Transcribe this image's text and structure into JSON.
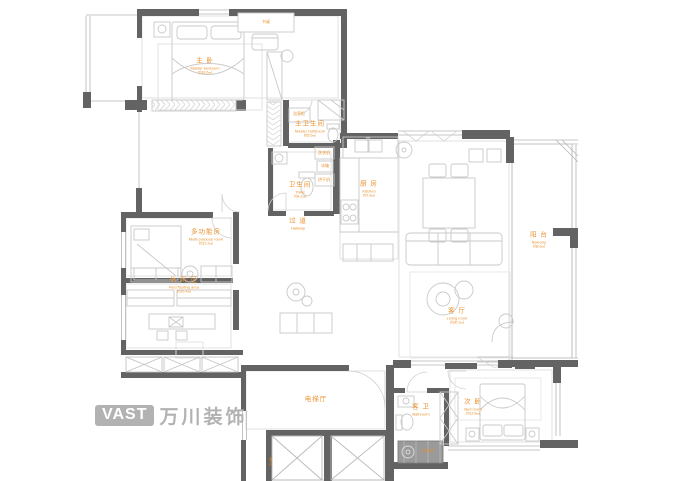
{
  "colors": {
    "wall": "#636363",
    "line": "#c9c9c9",
    "light_line": "#e0e0e0",
    "label_orange": "#e8922f",
    "logo_gray": "#b2b2b2",
    "dark_fixture": "#9a9a9a"
  },
  "logo": {
    "badge": "VAST",
    "name": "万川装饰"
  },
  "rooms": [
    {
      "id": "master-bedroom",
      "zh": "主 卧",
      "en": "Master bedroom",
      "area": "约18.6㎡"
    },
    {
      "id": "master-bathroom",
      "zh": "主卫生间",
      "en": "Master bathroom",
      "area": "约5.6㎡"
    },
    {
      "id": "bathroom",
      "zh": "卫生间",
      "en": "Toilet",
      "area": "约4.2㎡"
    },
    {
      "id": "hallway",
      "zh": "过 道",
      "en": "Hallway",
      "area": ""
    },
    {
      "id": "kitchen",
      "zh": "厨 房",
      "en": "Kitchen",
      "area": "约7.8㎡"
    },
    {
      "id": "living-room",
      "zh": "客 厅",
      "en": "Living room",
      "area": "约30.2㎡"
    },
    {
      "id": "balcony",
      "zh": "阳 台",
      "en": "Balcony",
      "area": "约8.6㎡"
    },
    {
      "id": "multi-purpose-room",
      "zh": "多功能房",
      "en": "Multi-purpose room",
      "area": "约13.2㎡"
    },
    {
      "id": "leisure-room",
      "zh": "休 闲 区",
      "en": "Rec/Tasting area",
      "area": "约16.4㎡"
    },
    {
      "id": "elevator-hall",
      "zh": "电梯厅",
      "en": "",
      "area": ""
    },
    {
      "id": "guest-bathroom",
      "zh": "客 卫",
      "en": "Bathroom",
      "area": ""
    },
    {
      "id": "second-bedroom",
      "zh": "次 卧",
      "en": "Bed room",
      "area": "约12.8㎡"
    }
  ],
  "fixtures": [
    {
      "id": "desk",
      "label": "书桌"
    },
    {
      "id": "vanity",
      "label": "浴室柜"
    },
    {
      "id": "washer",
      "label": "洗衣机"
    },
    {
      "id": "fridge",
      "label": "冰箱"
    },
    {
      "id": "dryer",
      "label": "烘干机"
    },
    {
      "id": "laundry",
      "label": "洗衣机"
    },
    {
      "id": "pipe-shaft",
      "label": "管井"
    }
  ]
}
